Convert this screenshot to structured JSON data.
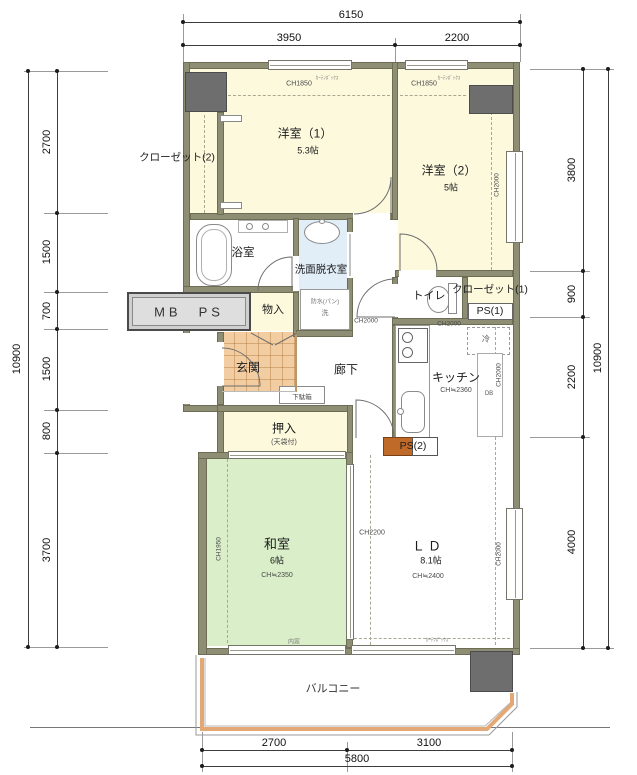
{
  "dims": {
    "top": {
      "overall": "6150",
      "seg1": "3950",
      "seg2": "2200"
    },
    "bottom": {
      "overall": "5800",
      "seg1": "2700",
      "seg2": "3100"
    },
    "left": {
      "overall": "10900",
      "seg1": "2700",
      "seg2": "1500",
      "seg3": "700",
      "seg4": "1500",
      "seg5": "800",
      "seg6": "3700"
    },
    "right": {
      "overall": "10900",
      "seg1": "3800",
      "seg2": "900",
      "seg3": "2200",
      "seg4": "4000"
    }
  },
  "rooms": {
    "closet2": {
      "label": "クローゼット(2)"
    },
    "western1": {
      "label": "洋室（1）",
      "size": "5.3帖",
      "ch": "CH1850",
      "curtain": "ｶｰﾃﾝﾎﾞｯｸｽ"
    },
    "western2": {
      "label": "洋室（2）",
      "size": "5帖",
      "ch": "CH1850",
      "curtain": "ｶｰﾃﾝﾎﾞｯｸｽ",
      "ch_side": "CH2000"
    },
    "bath": {
      "label": "浴室"
    },
    "washroom": {
      "label": "洗面脱衣室",
      "pan1": "防水(パン)",
      "pan2": "洗"
    },
    "mbps": {
      "label": "MB　PS"
    },
    "storage": {
      "label": "物入"
    },
    "genkan": {
      "label": "玄関"
    },
    "shoebox": {
      "label": "下駄箱"
    },
    "corridor": {
      "label": "廊下",
      "ch": "CH2000"
    },
    "toilet": {
      "label": "トイレ"
    },
    "closet1": {
      "label": "クローゼット(1)"
    },
    "ps1": {
      "label": "PS(1)"
    },
    "kitchen": {
      "label": "キッチン",
      "ch": "CH≒2360",
      "ch_top": "CH2000",
      "ch_side": "CH2000",
      "fridge": "冷",
      "db": "DB"
    },
    "oshiire": {
      "label": "押入",
      "note": "(天袋付)"
    },
    "ps2": {
      "label": "PS(2)"
    },
    "washitsu": {
      "label": "和室",
      "size": "6帖",
      "ch": "CH≒2350",
      "ch_side": "CH1950",
      "uchimado": "内窓"
    },
    "ld": {
      "label": "ＬＤ",
      "size": "8.1帖",
      "ch": "CH≒2400",
      "ch_mid": "CH2200",
      "ch_side": "CH2000",
      "curtain": "ｶｰﾃﾝﾎﾞｯｸｽ"
    },
    "balcony": {
      "label": "バルコニー"
    }
  },
  "colors": {
    "wall": "#8e8e74",
    "pillar": "#6e6e6e",
    "room_cream": "#fcf9dd",
    "tatami_green": "#d9eec9",
    "wash_blue": "#e1eef8",
    "genkan_tile": "#f2cda1",
    "ps2_orange": "#c06a2a",
    "balcony_fence": "#e3a874"
  }
}
